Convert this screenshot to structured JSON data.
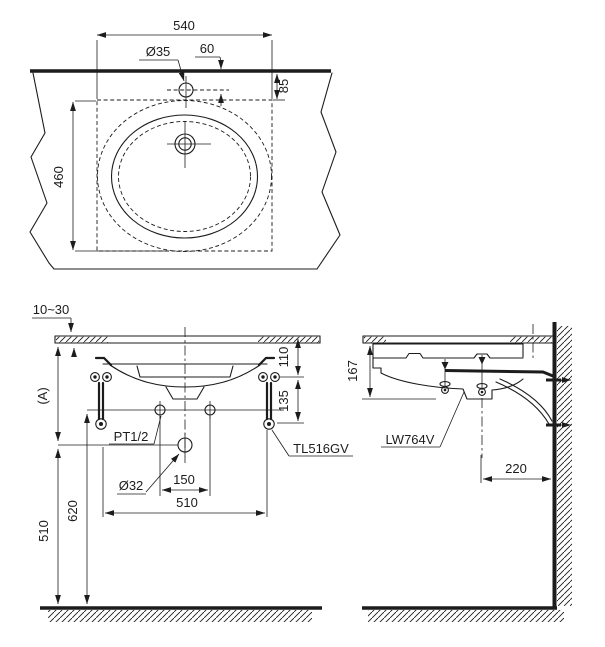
{
  "top": {
    "width": "540",
    "hole_dia": "Ø35",
    "hole_offset": "60",
    "rim_offset": "85",
    "depth": "460"
  },
  "front": {
    "counter_thickness": "10~30",
    "height_a": "(A)",
    "hanger_top_offset": "110",
    "hanger_hole_pitch": "135",
    "supply_thread": "PT1/2",
    "bracket_model": "TL516GV",
    "drain_dia": "Ø32",
    "supply_pitch": "150",
    "hanger_span": "510",
    "supply_height": "620",
    "drain_height": "510"
  },
  "side": {
    "depth_below_counter": "167",
    "basin_model": "LW764V",
    "drain_wall_offset": "220"
  },
  "colors": {
    "line": "#1c1c1c",
    "background": "#ffffff"
  }
}
